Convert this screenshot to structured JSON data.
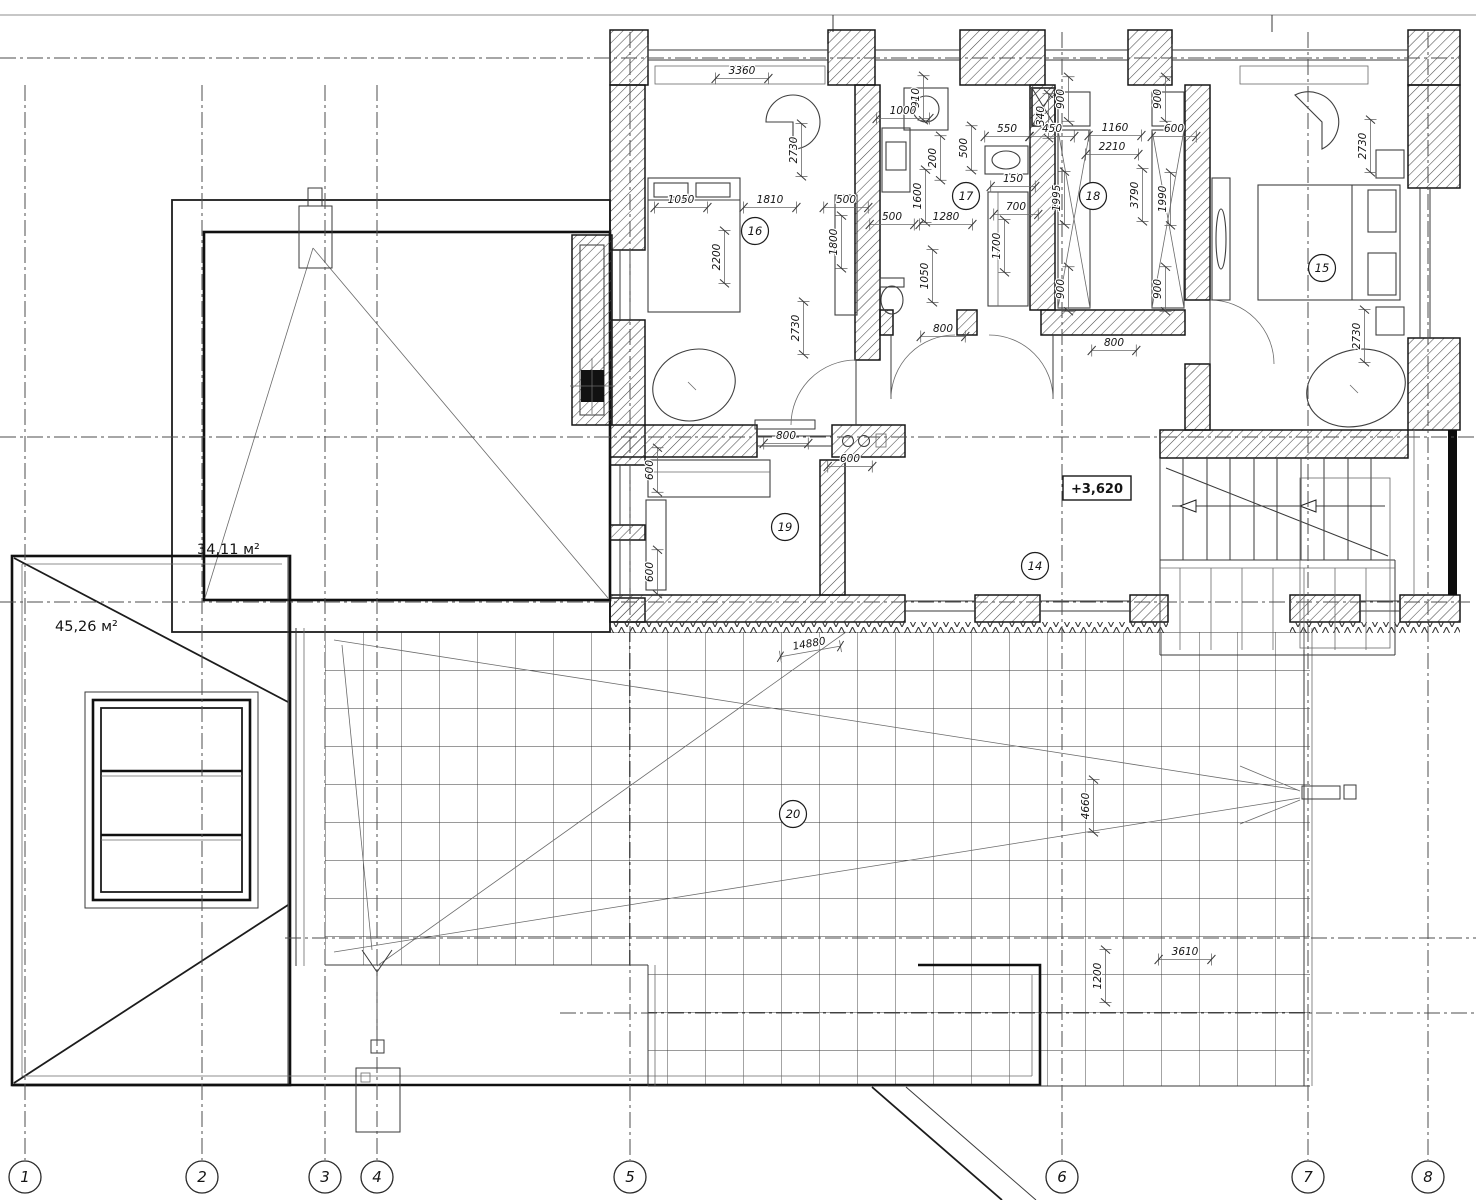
{
  "plan": {
    "elevation_mark": "+3,620",
    "areas": [
      {
        "text": "34,11 м²"
      },
      {
        "text": "45,26 м²"
      }
    ],
    "rooms": [
      {
        "label": "14",
        "x": 1035,
        "y": 566
      },
      {
        "label": "15",
        "x": 1322,
        "y": 268
      },
      {
        "label": "16",
        "x": 755,
        "y": 231
      },
      {
        "label": "17",
        "x": 966,
        "y": 196
      },
      {
        "label": "18",
        "x": 1093,
        "y": 196
      },
      {
        "label": "19",
        "x": 785,
        "y": 527
      },
      {
        "label": "20",
        "x": 793,
        "y": 814
      }
    ],
    "axes": [
      {
        "label": "1",
        "x": 25
      },
      {
        "label": "2",
        "x": 202
      },
      {
        "label": "3",
        "x": 325
      },
      {
        "label": "4",
        "x": 377
      },
      {
        "label": "5",
        "x": 630
      },
      {
        "label": "6",
        "x": 1062
      },
      {
        "label": "7",
        "x": 1308
      },
      {
        "label": "8",
        "x": 1428
      }
    ],
    "axis_row_y": 1177,
    "dimensions": [
      {
        "v": "3360",
        "x": 742,
        "y": 76
      },
      {
        "v": "1050",
        "x": 681,
        "y": 205
      },
      {
        "v": "1810",
        "x": 770,
        "y": 205
      },
      {
        "v": "500",
        "x": 846,
        "y": 205
      },
      {
        "v": "2200",
        "x": 722,
        "y": 257,
        "r": -90
      },
      {
        "v": "2730",
        "x": 799,
        "y": 150,
        "r": -90
      },
      {
        "v": "2730",
        "x": 801,
        "y": 328,
        "r": -90
      },
      {
        "v": "1800",
        "x": 839,
        "y": 242,
        "r": -90
      },
      {
        "v": "910",
        "x": 921,
        "y": 98,
        "r": -90
      },
      {
        "v": "1000",
        "x": 903,
        "y": 116
      },
      {
        "v": "200",
        "x": 938,
        "y": 158,
        "r": -90
      },
      {
        "v": "1600",
        "x": 923,
        "y": 196,
        "r": -90
      },
      {
        "v": "500",
        "x": 969,
        "y": 148,
        "r": -90
      },
      {
        "v": "550",
        "x": 1007,
        "y": 134
      },
      {
        "v": "150",
        "x": 1013,
        "y": 184
      },
      {
        "v": "700",
        "x": 1016,
        "y": 212
      },
      {
        "v": "1700",
        "x": 1002,
        "y": 246,
        "r": -90
      },
      {
        "v": "500",
        "x": 892,
        "y": 222
      },
      {
        "v": "1280",
        "x": 946,
        "y": 222
      },
      {
        "v": "1050",
        "x": 930,
        "y": 276,
        "r": -90
      },
      {
        "v": "800",
        "x": 943,
        "y": 334
      },
      {
        "v": "340",
        "x": 1046,
        "y": 116,
        "r": -90
      },
      {
        "v": "900",
        "x": 1066,
        "y": 99,
        "r": -90
      },
      {
        "v": "900",
        "x": 1163,
        "y": 99,
        "r": -90
      },
      {
        "v": "450",
        "x": 1052,
        "y": 134
      },
      {
        "v": "1160",
        "x": 1115,
        "y": 133
      },
      {
        "v": "600",
        "x": 1174,
        "y": 134
      },
      {
        "v": "2210",
        "x": 1112,
        "y": 152
      },
      {
        "v": "1995",
        "x": 1062,
        "y": 198,
        "r": -90
      },
      {
        "v": "3790",
        "x": 1140,
        "y": 195,
        "r": -90
      },
      {
        "v": "1990",
        "x": 1168,
        "y": 199,
        "r": -90
      },
      {
        "v": "900",
        "x": 1066,
        "y": 289,
        "r": -90
      },
      {
        "v": "900",
        "x": 1163,
        "y": 289,
        "r": -90
      },
      {
        "v": "800",
        "x": 1114,
        "y": 348
      },
      {
        "v": "2730",
        "x": 1368,
        "y": 146,
        "r": -90
      },
      {
        "v": "2730",
        "x": 1362,
        "y": 336,
        "r": -90
      },
      {
        "v": "800",
        "x": 786,
        "y": 441
      },
      {
        "v": "600",
        "x": 850,
        "y": 464
      },
      {
        "v": "600",
        "x": 655,
        "y": 470,
        "r": -90
      },
      {
        "v": "600",
        "x": 655,
        "y": 572,
        "r": -90
      },
      {
        "v": "14880",
        "x": 810,
        "y": 649,
        "r": -10
      },
      {
        "v": "4660",
        "x": 1091,
        "y": 806,
        "r": -90
      },
      {
        "v": "3610",
        "x": 1185,
        "y": 957
      },
      {
        "v": "1200",
        "x": 1103,
        "y": 976,
        "r": -90
      }
    ]
  }
}
